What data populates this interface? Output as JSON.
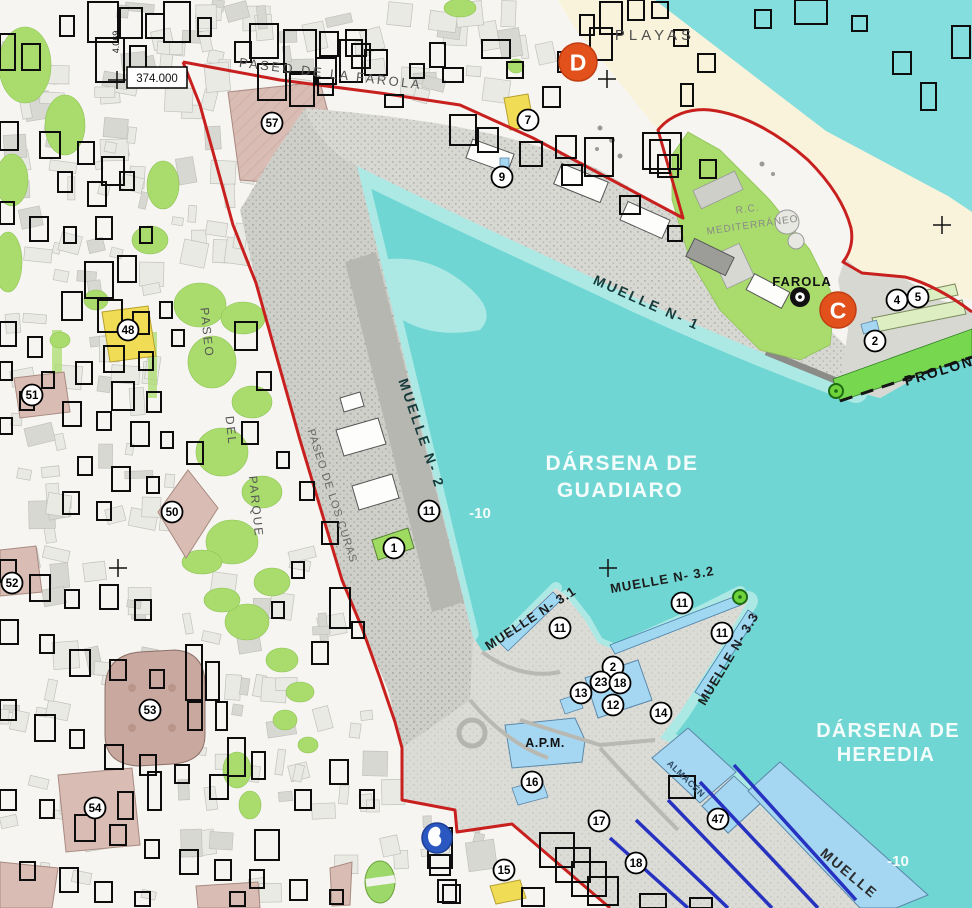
{
  "map": {
    "colors": {
      "water": "#6FD6D3",
      "water_light": "#ACE9E5",
      "sea": "#84DEDD",
      "beach": "#FAF3DB",
      "land": "#F6F5F1",
      "pier": "#D8D8D3",
      "pier_dark": "#B7B7B2",
      "park_green": "#A9DC6D",
      "dike_green": "#77D84F",
      "building_pink": "#D9BCB4",
      "building_yellow": "#F0DC55",
      "building_blue": "#A5D7F2",
      "shed_green": "#9FDB60",
      "rail_blue": "#2733C0",
      "boundary_red": "#C8201E",
      "marker_orange": "#E2511C",
      "marker_blue": "#2B57C0",
      "box_black": "#0d0d0d",
      "label_dark": "#173B3B",
      "label_gray": "#555555",
      "label_white": "#F4FCFB"
    },
    "water_labels": [
      {
        "text": "DÁRSENA DE",
        "x": 622,
        "y": 470,
        "rot": 0,
        "size": 21,
        "ls": 1.5,
        "color": "#F4FCFB",
        "w": 600
      },
      {
        "text": "GUADIARO",
        "x": 620,
        "y": 497,
        "rot": 0,
        "size": 21,
        "ls": 1.5,
        "color": "#F4FCFB",
        "w": 600
      },
      {
        "text": "DÁRSENA DE",
        "x": 888,
        "y": 737,
        "rot": 0,
        "size": 20,
        "ls": 1.2,
        "color": "#F4FCFB",
        "w": 600
      },
      {
        "text": "HEREDIA",
        "x": 886,
        "y": 761,
        "rot": 0,
        "size": 20,
        "ls": 1.2,
        "color": "#F4FCFB",
        "w": 600
      }
    ],
    "depth_labels": [
      {
        "text": "-10",
        "x": 480,
        "y": 518,
        "size": 15,
        "color": "#F4FCFB",
        "w": 600
      },
      {
        "text": "-10",
        "x": 898,
        "y": 866,
        "size": 15,
        "color": "#F4FCFB",
        "w": 600
      }
    ],
    "muelle_labels": [
      {
        "text": "MUELLE N- 1",
        "x": 645,
        "y": 307,
        "rot": 24,
        "size": 14,
        "ls": 2.5,
        "color": "#173B3B",
        "w": 600
      },
      {
        "text": "MUELLE N- 2",
        "x": 417,
        "y": 435,
        "rot": 71,
        "size": 14,
        "ls": 2.5,
        "color": "#173B3B",
        "w": 600
      },
      {
        "text": "MUELLE N- 3.1",
        "x": 533,
        "y": 622,
        "rot": -33,
        "size": 13,
        "ls": 1,
        "color": "#1c1c1c",
        "w": 600
      },
      {
        "text": "MUELLE N- 3.2",
        "x": 663,
        "y": 584,
        "rot": -10,
        "size": 13,
        "ls": 1,
        "color": "#1c1c1c",
        "w": 600
      },
      {
        "text": "MUELLE N- 3.3",
        "x": 732,
        "y": 661,
        "rot": -59,
        "size": 13,
        "ls": 1,
        "color": "#1c1c1c",
        "w": 600
      },
      {
        "text": "MUELLE",
        "x": 846,
        "y": 877,
        "rot": 40,
        "size": 14,
        "ls": 2,
        "color": "#2b2b2b",
        "w": 600
      }
    ],
    "street_labels": [
      {
        "text": "PASEO DE LA FAROLA",
        "x": 330,
        "y": 78,
        "rot": 7,
        "size": 13,
        "ls": 2.5,
        "color": "#555555",
        "w": 500
      },
      {
        "text": "PASEO",
        "x": 203,
        "y": 333,
        "rot": 84,
        "size": 12,
        "ls": 2,
        "color": "#555555",
        "w": 500
      },
      {
        "text": "DEL",
        "x": 227,
        "y": 431,
        "rot": 84,
        "size": 12,
        "ls": 2,
        "color": "#555555",
        "w": 500
      },
      {
        "text": "PARQUE",
        "x": 252,
        "y": 507,
        "rot": 84,
        "size": 12,
        "ls": 2,
        "color": "#555555",
        "w": 500
      },
      {
        "text": "PASEO DE LOS CURAS",
        "x": 329,
        "y": 497,
        "rot": 72,
        "size": 11,
        "ls": 1,
        "color": "#666666",
        "w": 500
      },
      {
        "text": "PLAYAS",
        "x": 655,
        "y": 40,
        "rot": 0,
        "size": 15,
        "ls": 4,
        "color": "#4f4f4f",
        "w": 500
      },
      {
        "text": "FAROLA",
        "x": 802,
        "y": 286,
        "rot": 0,
        "size": 13,
        "ls": 1,
        "color": "#111111",
        "w": 700
      },
      {
        "text": "R.C.",
        "x": 748,
        "y": 212,
        "rot": -8,
        "size": 10,
        "ls": 1,
        "color": "#8a8a86",
        "w": 500
      },
      {
        "text": "MEDITERRÁNEO",
        "x": 753,
        "y": 228,
        "rot": -8,
        "size": 10,
        "ls": 1,
        "color": "#8a8a86",
        "w": 500
      },
      {
        "text": "A.P.M.",
        "x": 545,
        "y": 747,
        "rot": 0,
        "size": 12.5,
        "ls": 0.5,
        "color": "#111111",
        "w": 700
      },
      {
        "text": "ALMACÉN",
        "x": 684,
        "y": 781,
        "rot": 44,
        "size": 9,
        "ls": 0.5,
        "color": "#2f4a66",
        "w": 600
      },
      {
        "text": "PROLON",
        "x": 906,
        "y": 386,
        "rot": -17,
        "size": 14,
        "ls": 2,
        "color": "#111111",
        "w": 600,
        "anchor": "start"
      }
    ],
    "coordinate_labels": [
      {
        "text": "374.000",
        "x": 157,
        "y": 82,
        "rot": 0,
        "size": 11.5,
        "color": "#111111",
        "boxed": true
      },
      {
        "text": "4.069",
        "x": 119,
        "y": 42,
        "rot": -90,
        "size": 9,
        "color": "#111111",
        "boxed": false
      }
    ],
    "numbered_markers": [
      {
        "n": "57",
        "x": 272,
        "y": 123
      },
      {
        "n": "7",
        "x": 528,
        "y": 120
      },
      {
        "n": "9",
        "x": 502,
        "y": 177
      },
      {
        "n": "48",
        "x": 128,
        "y": 330
      },
      {
        "n": "51",
        "x": 32,
        "y": 395
      },
      {
        "n": "50",
        "x": 172,
        "y": 512
      },
      {
        "n": "52",
        "x": 12,
        "y": 583
      },
      {
        "n": "53",
        "x": 150,
        "y": 710
      },
      {
        "n": "54",
        "x": 95,
        "y": 808
      },
      {
        "n": "11",
        "x": 429,
        "y": 511
      },
      {
        "n": "1",
        "x": 394,
        "y": 548
      },
      {
        "n": "11",
        "x": 560,
        "y": 628
      },
      {
        "n": "11",
        "x": 682,
        "y": 603
      },
      {
        "n": "11",
        "x": 722,
        "y": 633
      },
      {
        "n": "2",
        "x": 613,
        "y": 667
      },
      {
        "n": "23",
        "x": 601,
        "y": 682
      },
      {
        "n": "18",
        "x": 620,
        "y": 683
      },
      {
        "n": "13",
        "x": 581,
        "y": 693
      },
      {
        "n": "12",
        "x": 613,
        "y": 705
      },
      {
        "n": "14",
        "x": 661,
        "y": 713
      },
      {
        "n": "16",
        "x": 532,
        "y": 782
      },
      {
        "n": "17",
        "x": 599,
        "y": 821
      },
      {
        "n": "15",
        "x": 504,
        "y": 870
      },
      {
        "n": "18",
        "x": 636,
        "y": 863
      },
      {
        "n": "47",
        "x": 718,
        "y": 819
      },
      {
        "n": "2",
        "x": 875,
        "y": 341
      },
      {
        "n": "4",
        "x": 897,
        "y": 300
      },
      {
        "n": "5",
        "x": 918,
        "y": 297
      }
    ],
    "letter_markers": [
      {
        "letter": "D",
        "x": 578,
        "y": 62,
        "r": 19,
        "fill": "#E2511C",
        "ring": "#C13E12",
        "text_color": "#ffffff"
      },
      {
        "letter": "C",
        "x": 838,
        "y": 310,
        "r": 18,
        "fill": "#E2511C",
        "ring": "#C13E12",
        "text_color": "#ffffff"
      },
      {
        "letter": "",
        "x": 437,
        "y": 838,
        "r": 15,
        "fill": "#2B57C0",
        "ring": "#1d3f94",
        "text_color": "#ffffff",
        "glyph": "blob"
      }
    ],
    "lighthouse_marker": {
      "x": 800,
      "y": 297
    },
    "green_dots": [
      {
        "x": 836,
        "y": 391
      },
      {
        "x": 740,
        "y": 597
      }
    ],
    "crosses": [
      {
        "x": 117,
        "y": 80
      },
      {
        "x": 607,
        "y": 79
      },
      {
        "x": 608,
        "y": 568
      },
      {
        "x": 118,
        "y": 568
      },
      {
        "x": 942,
        "y": 225
      }
    ]
  }
}
